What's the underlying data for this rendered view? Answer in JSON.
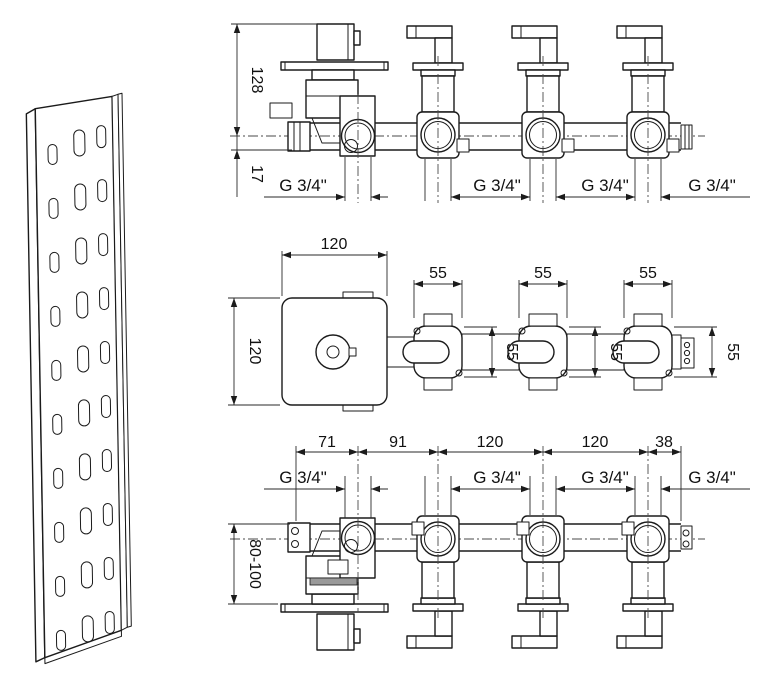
{
  "front": {
    "dim_handle_height": "128",
    "dim_pipe_offset": "17",
    "ports": [
      "G 3/4\"",
      "G 3/4\"",
      "G 3/4\"",
      "G 3/4\""
    ]
  },
  "plan": {
    "dim_block_width": "120",
    "dim_block_height": "120",
    "dim_valve_widths": [
      "55",
      "55",
      "55"
    ],
    "dim_valve_depths": [
      "55",
      "55",
      "55"
    ]
  },
  "bottom": {
    "dim_spacings": [
      "71",
      "91",
      "120",
      "120",
      "38"
    ],
    "dim_mount_depth": "80-100",
    "ports": [
      "G 3/4\"",
      "G 3/4\"",
      "G 3/4\"",
      "G 3/4\""
    ]
  }
}
